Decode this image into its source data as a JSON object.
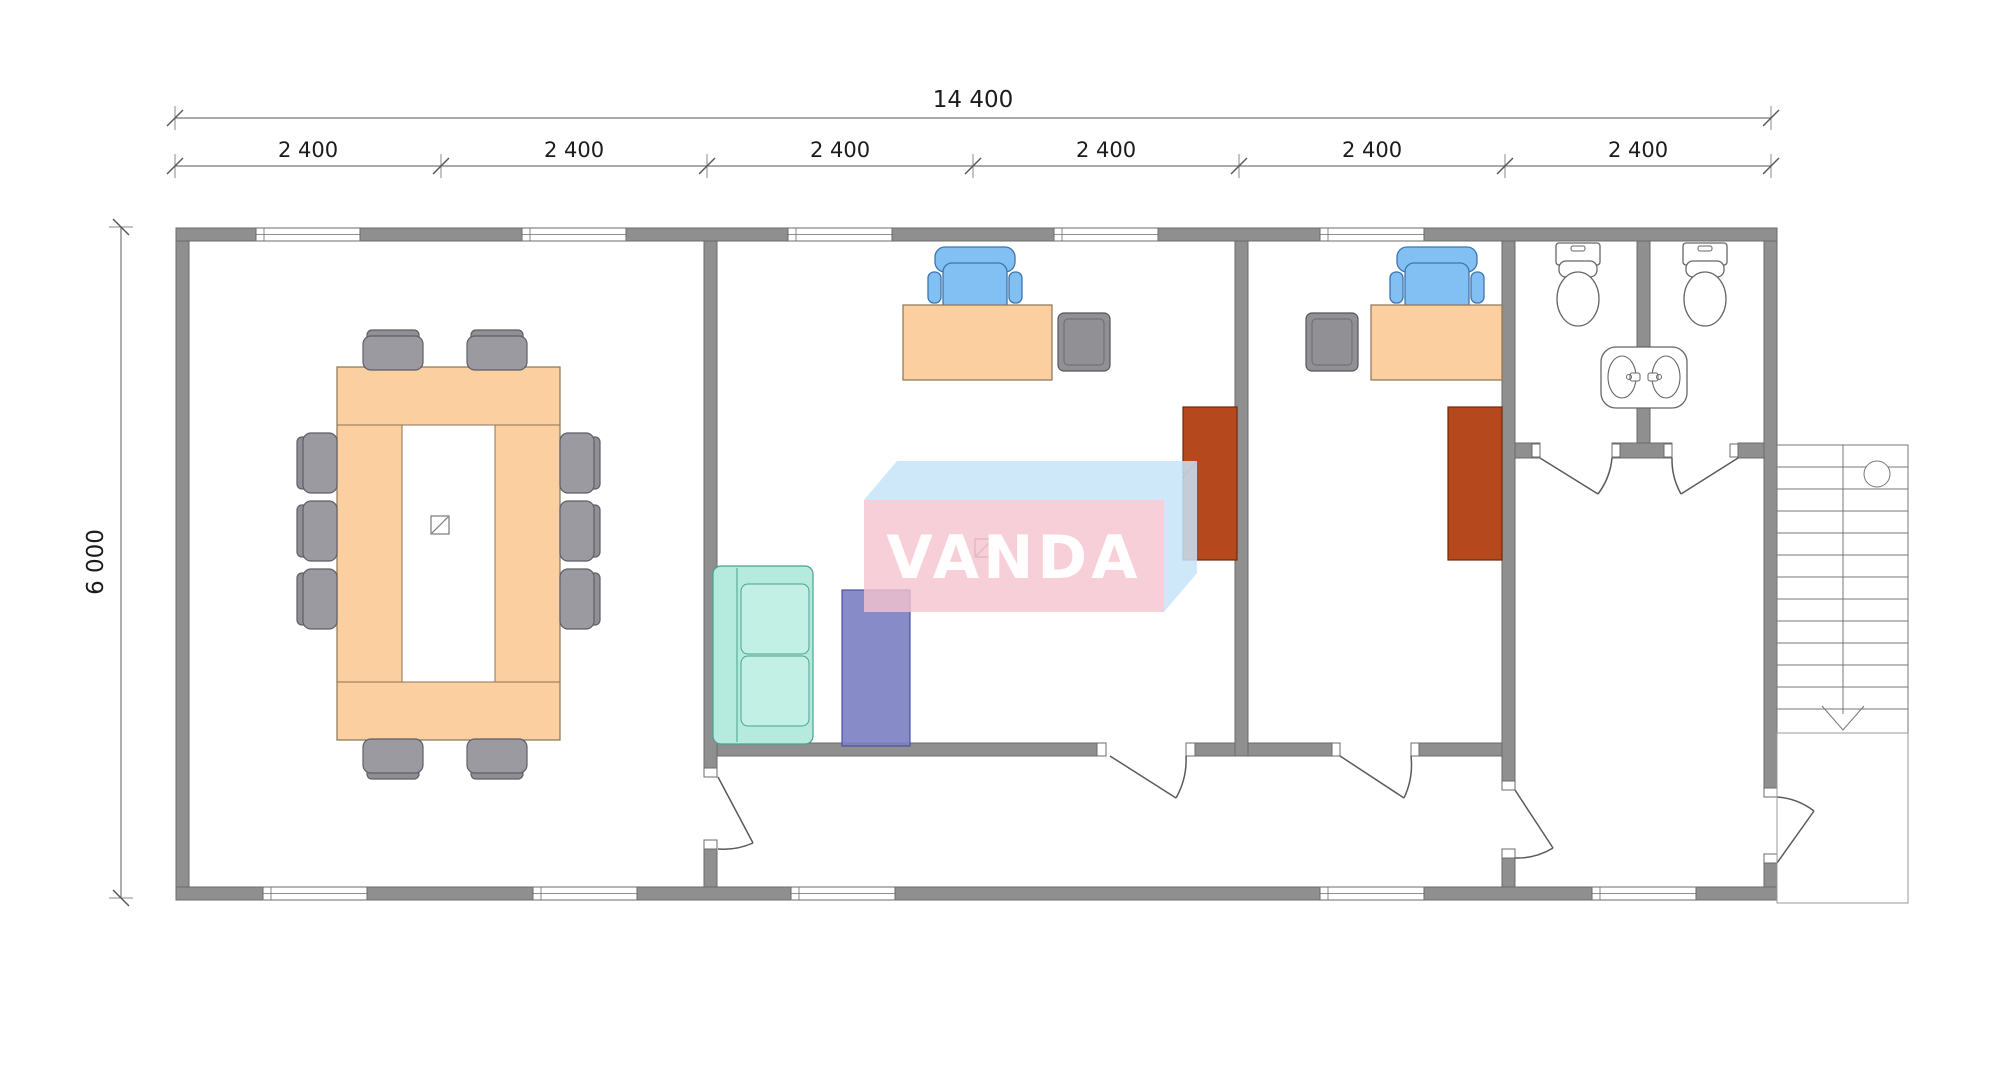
{
  "drawing": {
    "type": "architectural-floor-plan",
    "watermark": {
      "text": "VANDA",
      "front_color": "#f5c3ce",
      "side_color": "#c6e4f8",
      "text_color": "#ffffff"
    },
    "dimensions": {
      "total_width_label": "14 400",
      "height_label": "6 000",
      "segment_labels": [
        "2 400",
        "2 400",
        "2 400",
        "2 400",
        "2 400",
        "2 400"
      ]
    },
    "colors": {
      "wall": "#8f8f8f",
      "wall_outline": "#6b6b6b",
      "table_and_desks": "#fbcfa0",
      "meeting_chairs": "#9a9aa0",
      "office_chairs": "#82c0f4",
      "sofa": "#b5ebdf",
      "tall_cabinets": "#b5481d",
      "pedestal_cabinets": "#909095",
      "armchair": "#7d81c2"
    }
  }
}
